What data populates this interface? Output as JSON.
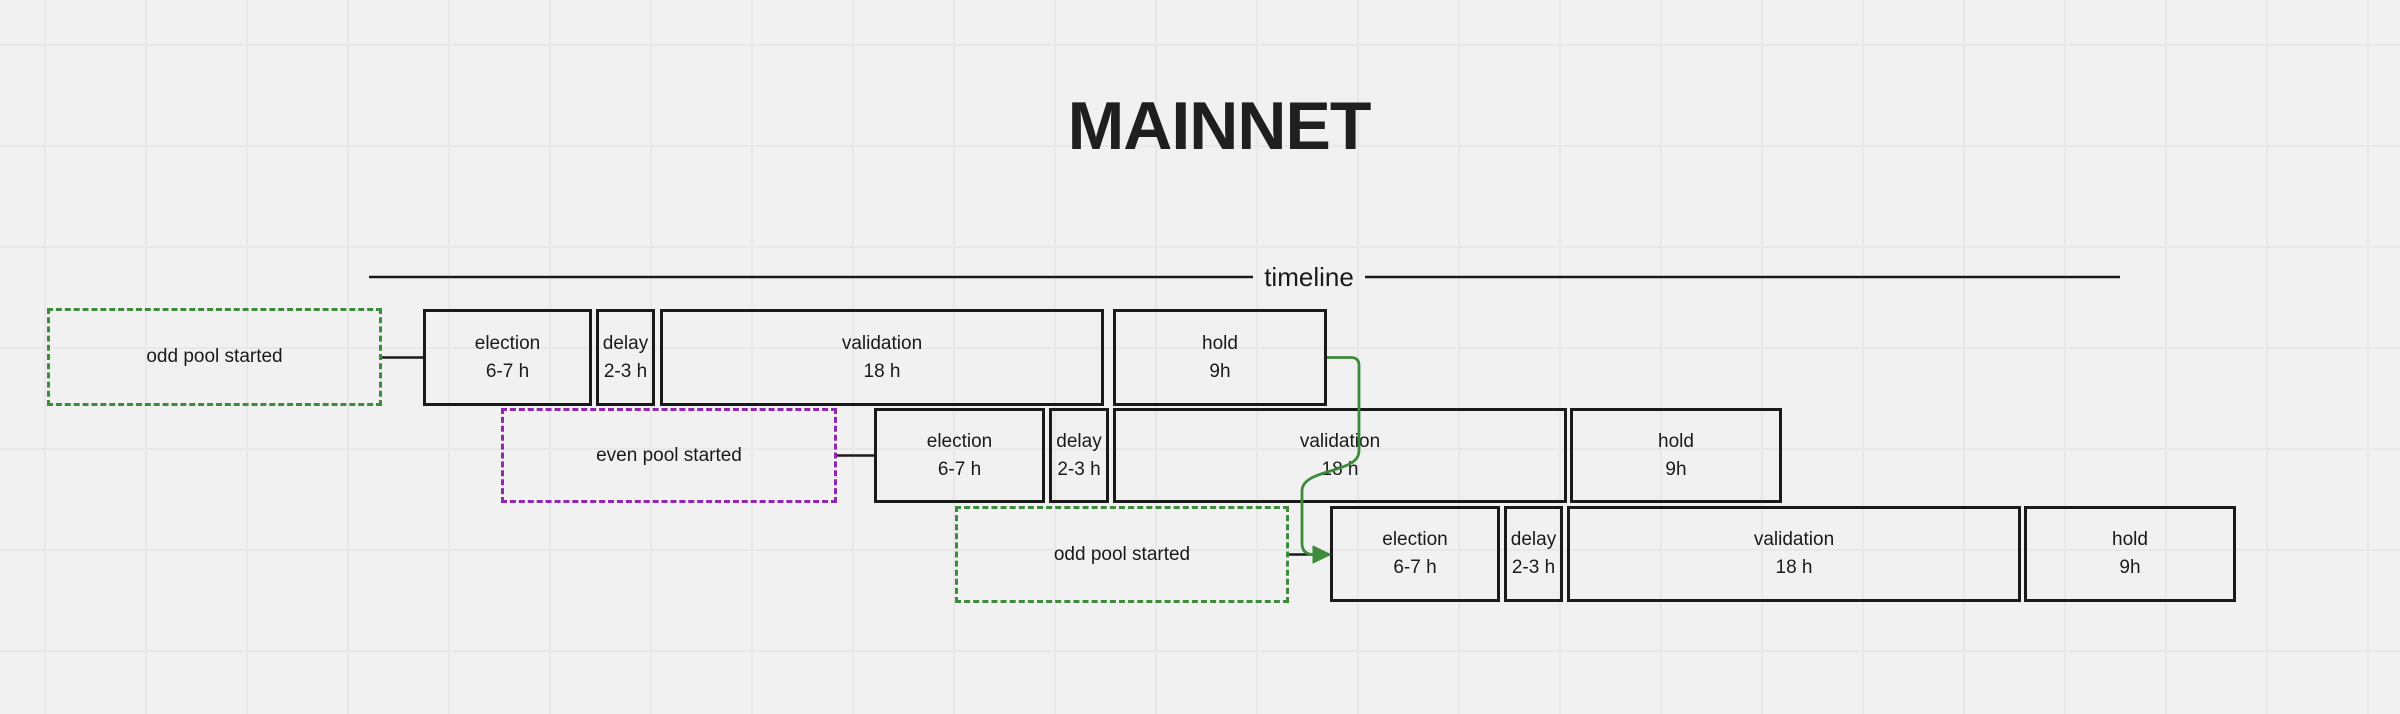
{
  "title": "MAINNET",
  "timeline": {
    "label": "timeline"
  },
  "colors": {
    "background": "#f1f1f1",
    "grid_line": "#e8e8e8",
    "box_border": "#1a1a1a",
    "text": "#1a1a1a",
    "odd_pool_green": "#3c8c3c",
    "even_pool_purple": "#9127b0",
    "arrow_green": "#3c8c3c"
  },
  "rows": [
    {
      "start": {
        "label": "odd pool started"
      },
      "phases": [
        {
          "name": "election",
          "duration": "6-7 h"
        },
        {
          "name": "delay",
          "duration": "2-3 h"
        },
        {
          "name": "validation",
          "duration": "18 h"
        },
        {
          "name": "hold",
          "duration": "9h"
        }
      ]
    },
    {
      "start": {
        "label": "even pool started"
      },
      "phases": [
        {
          "name": "election",
          "duration": "6-7 h"
        },
        {
          "name": "delay",
          "duration": "2-3 h"
        },
        {
          "name": "validation",
          "duration": "18 h"
        },
        {
          "name": "hold",
          "duration": "9h"
        }
      ]
    },
    {
      "start": {
        "label": "odd pool started"
      },
      "phases": [
        {
          "name": "election",
          "duration": "6-7 h"
        },
        {
          "name": "delay",
          "duration": "2-3 h"
        },
        {
          "name": "validation",
          "duration": "18 h"
        },
        {
          "name": "hold",
          "duration": "9h"
        }
      ]
    }
  ]
}
